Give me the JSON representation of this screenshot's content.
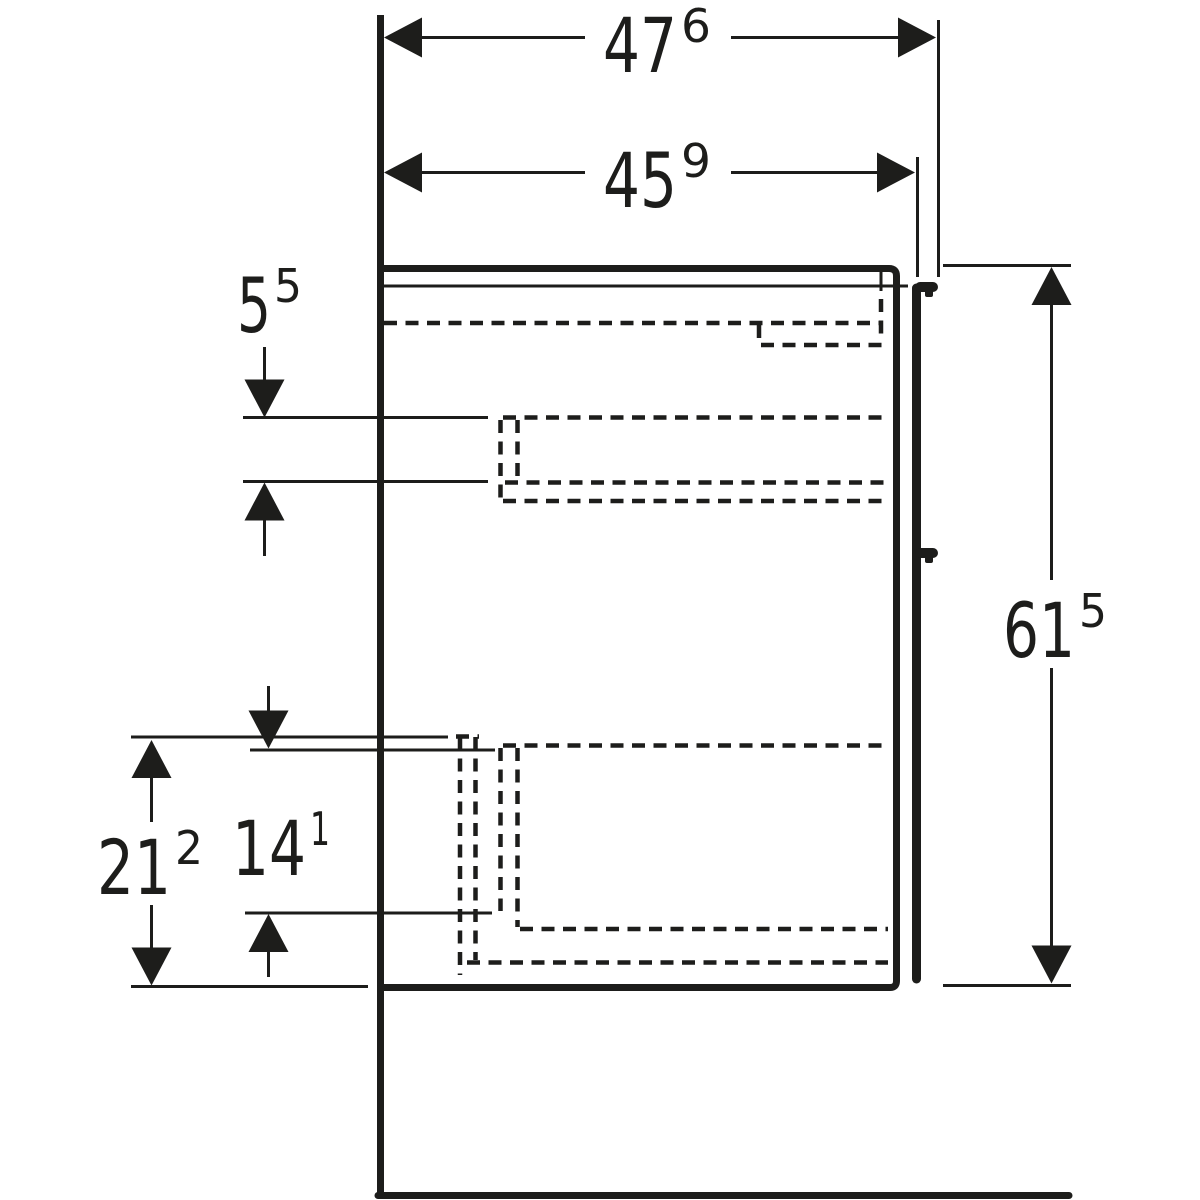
{
  "drawing": {
    "type": "furniture-side-view-dimension-drawing",
    "background": "#ffffff",
    "line_color": "#1d1d1b",
    "unit_note": "labels shown as value with superscript decimal",
    "labels": {
      "top_width": {
        "main": "47",
        "sup": "6",
        "value_cm": 47.6
      },
      "inner_width": {
        "main": "45",
        "sup": "9",
        "value_cm": 45.9
      },
      "upper_left": {
        "main": "5",
        "sup": "5",
        "value_cm": 5.5
      },
      "height_right": {
        "main": "61",
        "sup": "5",
        "value_cm": 61.5
      },
      "lower_left_outer": {
        "main": "21",
        "sup": "2",
        "value_cm": 21.2
      },
      "lower_left_inner": {
        "main": "14",
        "sup": "1",
        "value_cm": 14.1
      }
    }
  }
}
